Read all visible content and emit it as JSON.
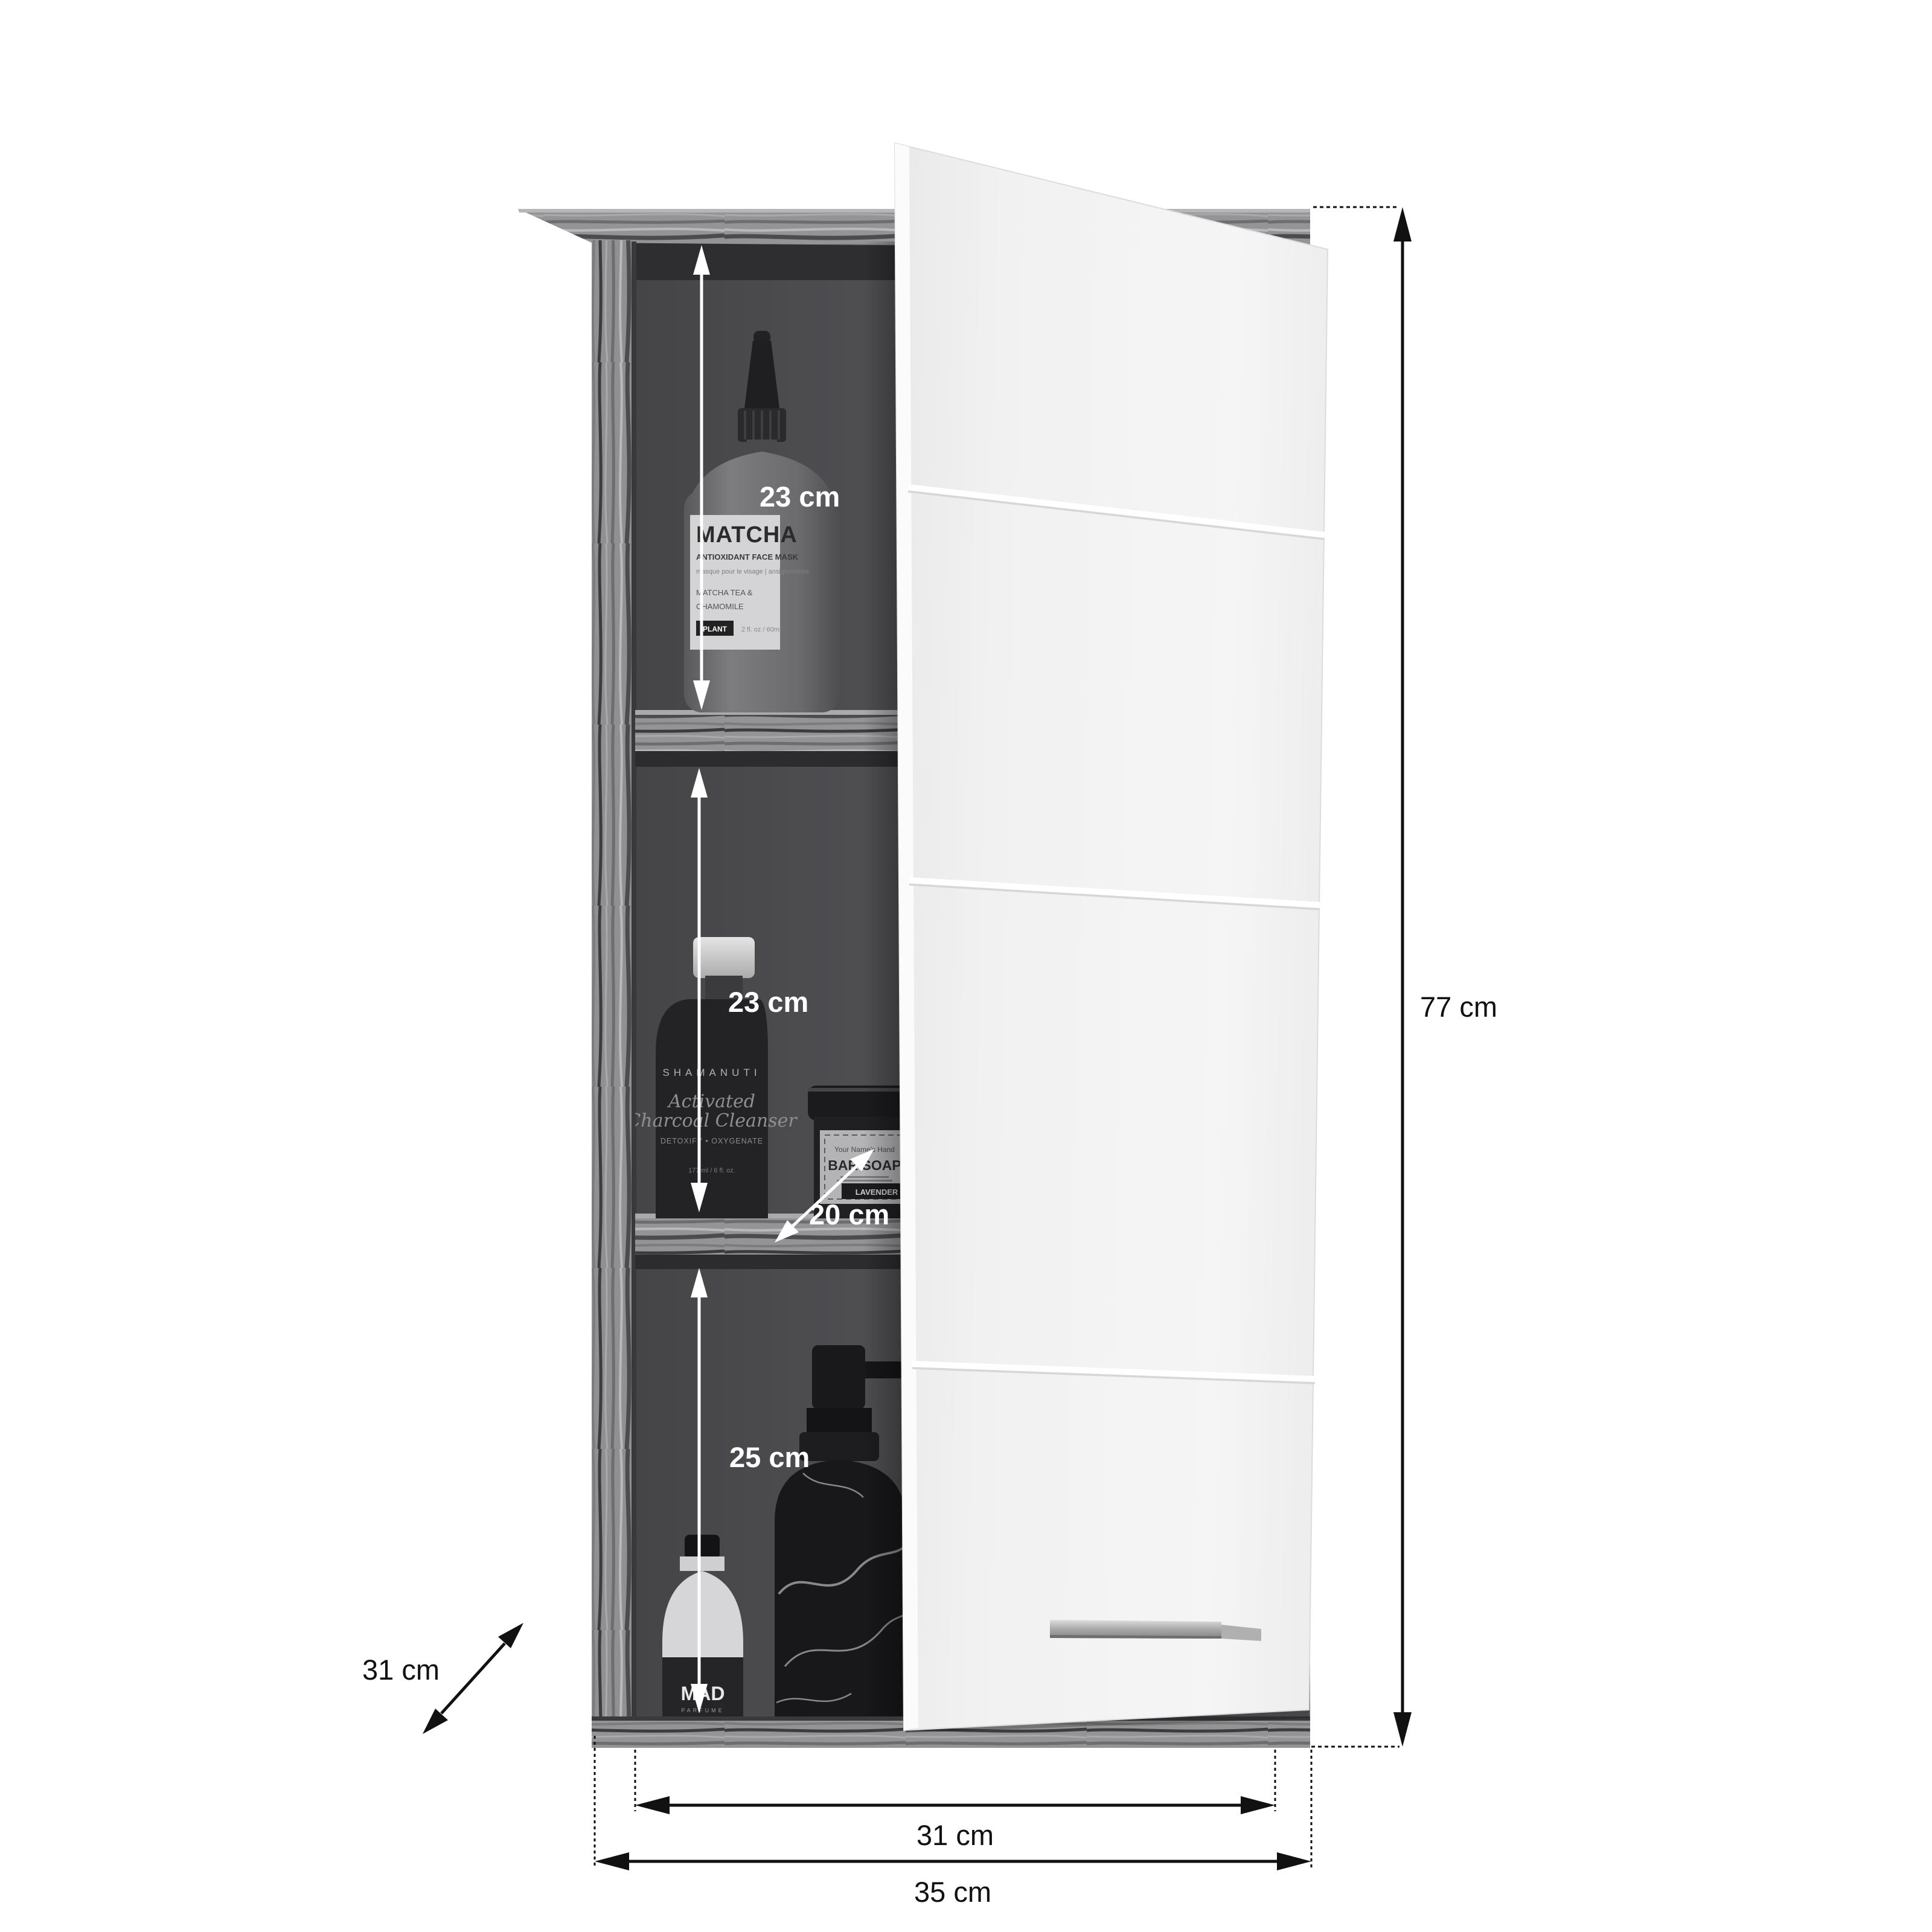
{
  "diagram": {
    "type": "bathroom wall cabinet dimension diagram",
    "colors": {
      "background": "#ffffff",
      "wood_base": "#8f8f8f",
      "wood_dark_streak": "#4a4a4c",
      "interior": "#505053",
      "door": "#f2f2f2",
      "handle": "#b5b5b5",
      "annotation_inside": "#ffffff",
      "annotation_outside": "#111111"
    }
  },
  "dimensions": {
    "top_compartment_height": "23 cm",
    "middle_compartment_height": "23 cm",
    "jar_shelf_depth": "20 cm",
    "bottom_compartment_height": "25 cm",
    "side_depth": "31 cm",
    "total_height": "77 cm",
    "inner_width": "31 cm",
    "total_width": "35 cm"
  },
  "products": {
    "matcha": {
      "title": "MATCHA",
      "subtitle": "ANTIOXIDANT FACE MASK",
      "translation": "masque pour le visage | ansigtsmaske",
      "ingredient1": "MATCHA TEA &",
      "ingredient2": "CHAMOMILE",
      "badge": "PLANT",
      "volume": "2 fl. oz / 60ml"
    },
    "cleanser": {
      "brand": "SHAMANUTI",
      "script_line1": "Activated",
      "script_line2": "Charcoal Cleanser",
      "claim": "DETOXIFY • OXYGENATE",
      "volume": "177 ml / 6 fl. oz."
    },
    "soap_jar": {
      "header": "Your Name's Hand",
      "title": "BAR SOAP",
      "ribbon": "LAVENDER"
    },
    "perfume": {
      "logo": "MAD",
      "sub": "PARFUME"
    }
  }
}
